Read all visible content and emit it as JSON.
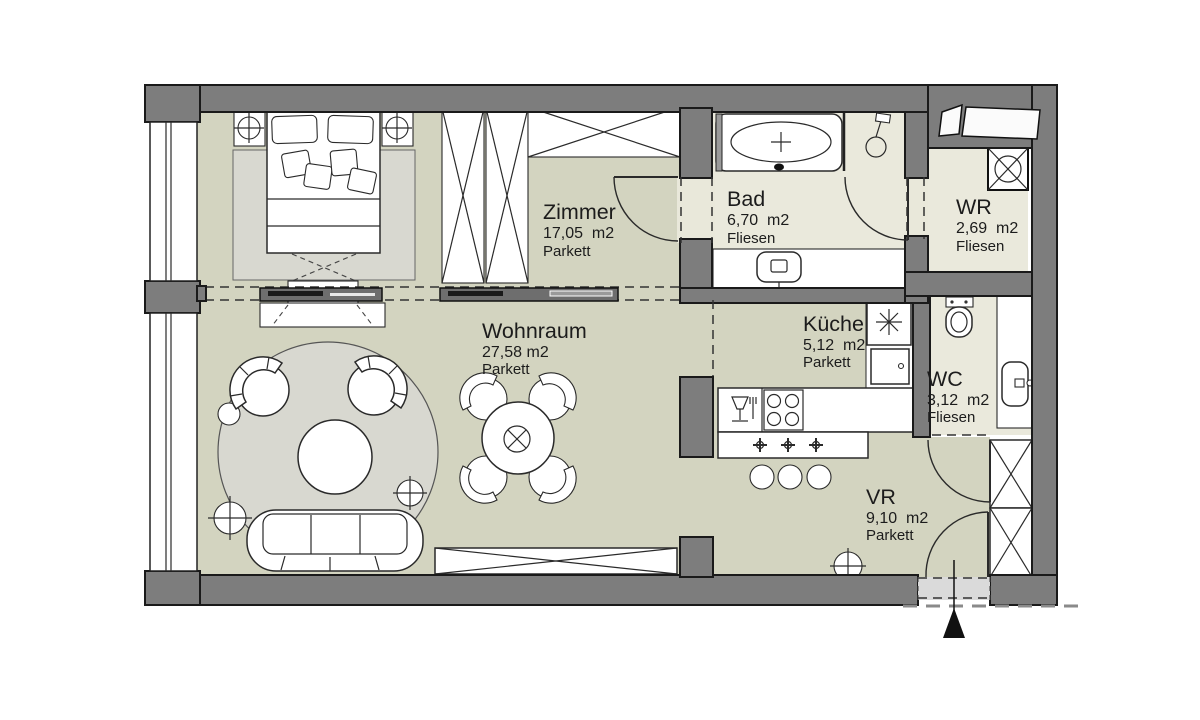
{
  "title": "Apartment floor plan",
  "colors": {
    "wall": "#7d7d7d",
    "wall_outline": "#1a1a1a",
    "floor_parkett": "#d3d4c0",
    "floor_fliesen": "#eae9dc",
    "rug": "#d8d8d0",
    "furniture": "#ffffff",
    "vestibule": "#dadada",
    "entrance_arrow": "#111111"
  },
  "rooms": [
    {
      "name": "Zimmer",
      "area": "17,05  m2",
      "floor": "Parkett"
    },
    {
      "name": "Bad",
      "area": "6,70  m2",
      "floor": "Fliesen"
    },
    {
      "name": "WR",
      "area": "2,69  m2",
      "floor": "Fliesen"
    },
    {
      "name": "Wohnraum",
      "area": "27,58 m2",
      "floor": "Parkett"
    },
    {
      "name": "Küche",
      "area": "5,12  m2",
      "floor": "Parkett"
    },
    {
      "name": "WC",
      "area": "3,12  m2",
      "floor": "Fliesen"
    },
    {
      "name": "VR",
      "area": "9,10  m2",
      "floor": "Parkett"
    }
  ]
}
